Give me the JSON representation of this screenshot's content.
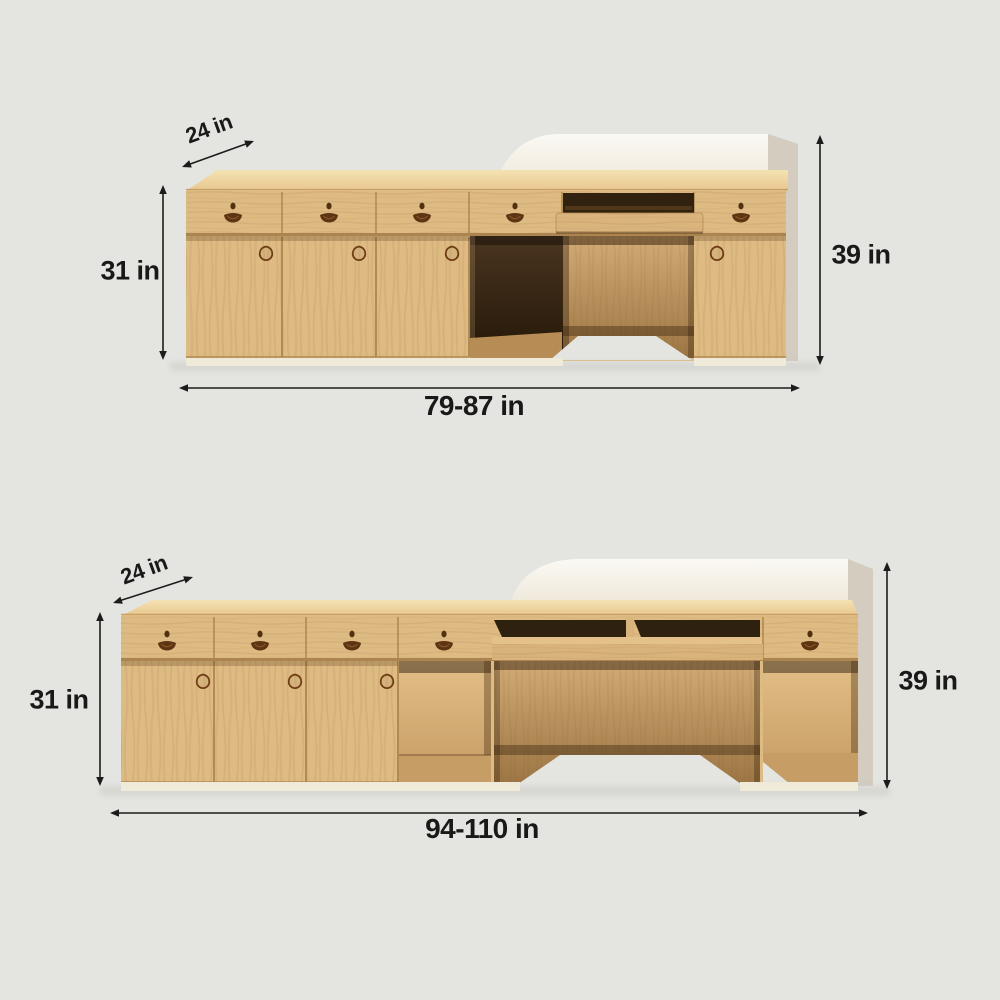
{
  "diagrams": {
    "top": {
      "depth_label": "24 in",
      "cabinet_height_label": "31 in",
      "total_height_label": "39 in",
      "width_label": "79-87 in"
    },
    "bottom": {
      "depth_label": "24 in",
      "cabinet_height_label": "31 in",
      "total_height_label": "39 in",
      "width_label": "94-110 in"
    }
  },
  "colors": {
    "background": "#e4e5e1",
    "wood_front": "#debb83",
    "wood_top": "#eed3a2",
    "wood_interior_dark": "#3c2b17",
    "wood_interior_mid": "#c49c68",
    "privacy_panel_white": "#f8f5ee",
    "panel_side_gray": "#d3ccbf",
    "handle_brown": "#5e3513",
    "dimension_text": "#191919"
  }
}
